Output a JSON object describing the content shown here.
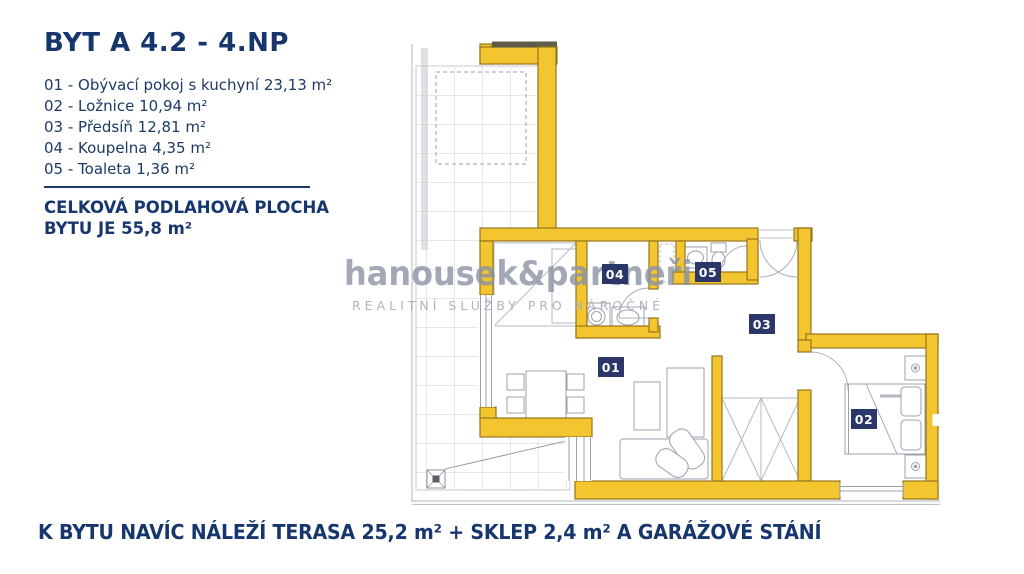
{
  "header": {
    "title": "BYT A 4.2 - 4.NP"
  },
  "legend": {
    "items": [
      "01 - Obývací pokoj s kuchyní 23,13 m²",
      "02 - Ložnice 10,94 m²",
      "03 - Předsíň 12,81 m²",
      "04 - Koupelna 4,35 m²",
      "05 - Toaleta 1,36 m²"
    ],
    "total_line1": "CELKOVÁ PODLAHOVÁ PLOCHA",
    "total_line2": "BYTU JE 55,8 m²"
  },
  "watermark": {
    "brand": "hanousek&partneři",
    "tagline": "REALITNÍ SLUŽBY PRO NÁROČNÉ"
  },
  "plan": {
    "room_labels": [
      "01",
      "02",
      "03",
      "04",
      "05"
    ]
  },
  "footer": {
    "note": "K BYTU NAVÍC NÁLEŽÍ TERASA 25,2 m² + SKLEP 2,4 m² A GARÁŽOVÉ STÁNÍ"
  },
  "colors": {
    "navy_text": "#17366e",
    "badge_navy": "#2a3768",
    "wall_yellow": "#f3c52f",
    "wall_outline": "#96761c",
    "watermark_gray": "#8b93a3"
  }
}
